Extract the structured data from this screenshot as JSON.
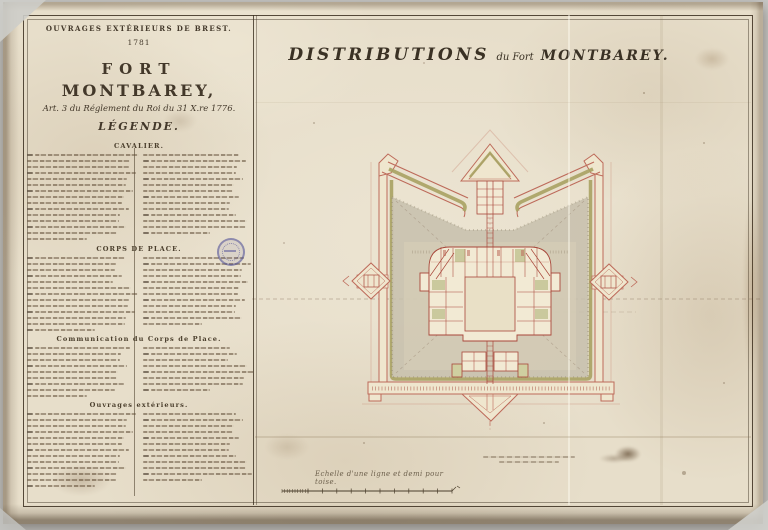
{
  "legend": {
    "series_title": "OUVRAGES EXTÉRIEURS DE BREST.",
    "year": "1781",
    "fort_title_line1": "FORT",
    "fort_title_line2": "MONTBAREY,",
    "regulation": "Art. 3 du Réglement du Roi du 31 X.re 1776.",
    "legend_heading": "LÉGENDE.",
    "sections": [
      {
        "heading": "CAVALIER.",
        "left_lines": 15,
        "right_lines": 14
      },
      {
        "heading": "CORPS DE PLACE.",
        "left_lines": 13,
        "right_lines": 12
      },
      {
        "heading": "Communication du Corps de Place.",
        "left_lines": 9,
        "right_lines": 8
      },
      {
        "heading": "Ouvrages extérieurs.",
        "left_lines": 13,
        "right_lines": 12
      }
    ]
  },
  "map": {
    "title_main": "DISTRIBUTIONS",
    "title_middle": "du Fort",
    "title_end": "MONTBAREY.",
    "scale_caption": "Echelle d'une ligne et demi pour toise.",
    "note_lines": 2
  },
  "plan_colors": {
    "wall": "#bd6a5a",
    "wall_dark": "#a8473a",
    "glacis_olive": "#a9a263",
    "terreplein_grey": "#c7c0ad",
    "rampart_fill": "#efe6ce",
    "ink": "#43382a",
    "stamp": "#5656a0"
  }
}
